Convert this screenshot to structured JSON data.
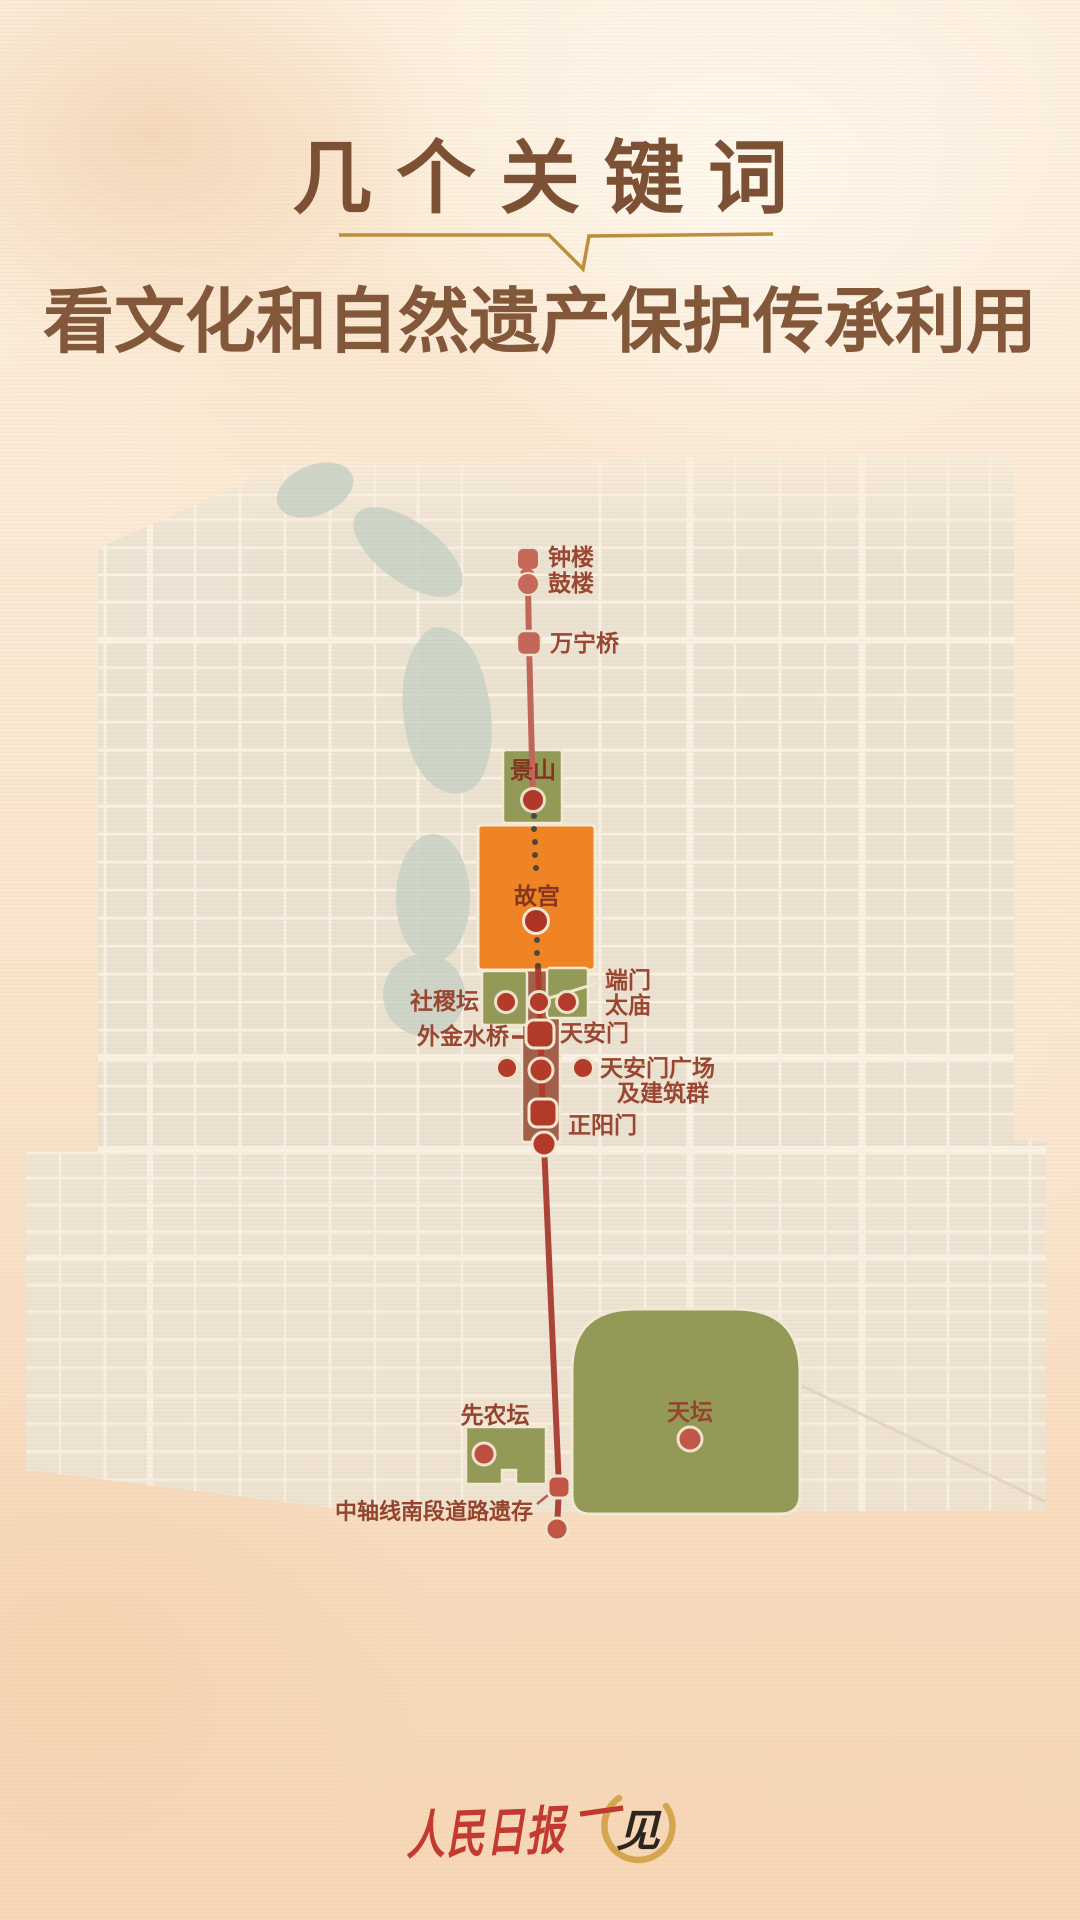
{
  "title": {
    "line1": "几个关键词",
    "line2": "看文化和自然遗产保护传承利用"
  },
  "map_labels": {
    "zhonglou": "钟楼",
    "gulou": "鼓楼",
    "wanningqiao": "万宁桥",
    "jingshan": "景山",
    "gugong": "故宫",
    "shejitan": "社稷坛",
    "duanmen": "端门",
    "taimiao": "太庙",
    "waijinshuiqiao": "外金水桥",
    "tiananmen": "天安门",
    "guangchang_line1": "天安门广场",
    "guangchang_line2": "及建筑群",
    "zhengyangmen": "正阳门",
    "xiannongtan": "先农坛",
    "tiantan": "天坛",
    "zhouxian_nanduan": "中轴线南段道路遗存"
  },
  "footer": {
    "brand": "人民日报",
    "logo_stroke": "一",
    "logo_char": "见"
  },
  "colors": {
    "background_peach_top": "#fcf0df",
    "background_peach_bottom": "#f6d6b5",
    "title_brown": "#7b5034",
    "underline_gold": "#bb8f3b",
    "axis_red_central": "#b23a2b",
    "axis_salmon_north": "#c0665a",
    "axis_red_south": "#ad4338",
    "dot_salmon": "#c5695a",
    "dot_dark_red": "#b0392c",
    "landmark_green": "#939a58",
    "palace_orange": "#f08424",
    "square_brown": "#a2604b",
    "label_red": "#9a4631",
    "lake_sage": "#c9d2c6",
    "map_block": "#e8e1d2",
    "street_cream": "#f9f4e9",
    "brand_red": "#c23a30",
    "logo_gold": "#d6a64e",
    "logo_black": "#2c241e"
  }
}
